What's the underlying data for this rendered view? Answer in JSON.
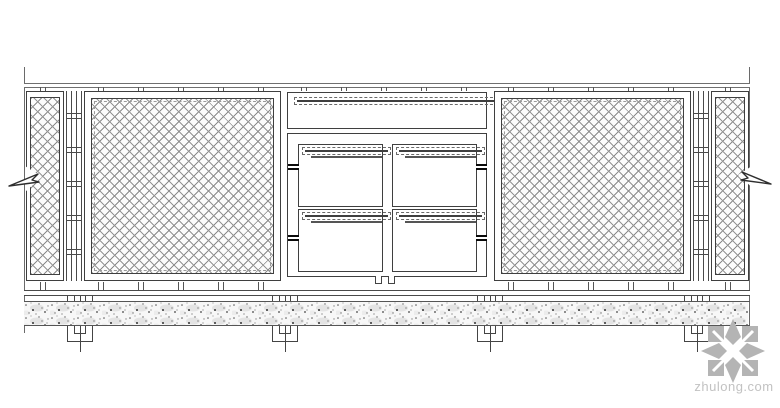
{
  "drawing": {
    "type": "fence-balustrade-elevation",
    "components": [
      "left break line with arrow",
      "left partial wire-mesh panel",
      "post with connector ticks",
      "large wire-mesh panel",
      "top horizontal framed strip panel (blank infill)",
      "center frame with four small panels: mesh, mesh, blank, mesh",
      "large wire-mesh panel",
      "post with connector ticks",
      "right partial wire-mesh panel",
      "right break line with arrow",
      "top rail",
      "bottom rail",
      "stippled concrete plinth band",
      "four buried post footings"
    ],
    "center_panels": [
      {
        "position": "top-left",
        "infill": "mesh"
      },
      {
        "position": "top-right",
        "infill": "mesh"
      },
      {
        "position": "bottom-left",
        "infill": "blank"
      },
      {
        "position": "bottom-right",
        "infill": "mesh"
      }
    ]
  },
  "watermark": {
    "text": "zhulong.com",
    "logo": "compass-flower-icon",
    "logo_color": "#b4b4b4",
    "text_color": "#c2c2c2"
  },
  "colors": {
    "background": "#ffffff",
    "line": "#3f3f3f",
    "rail": "#6f6f6f",
    "mesh": "#949494",
    "speckle": "#444444"
  }
}
